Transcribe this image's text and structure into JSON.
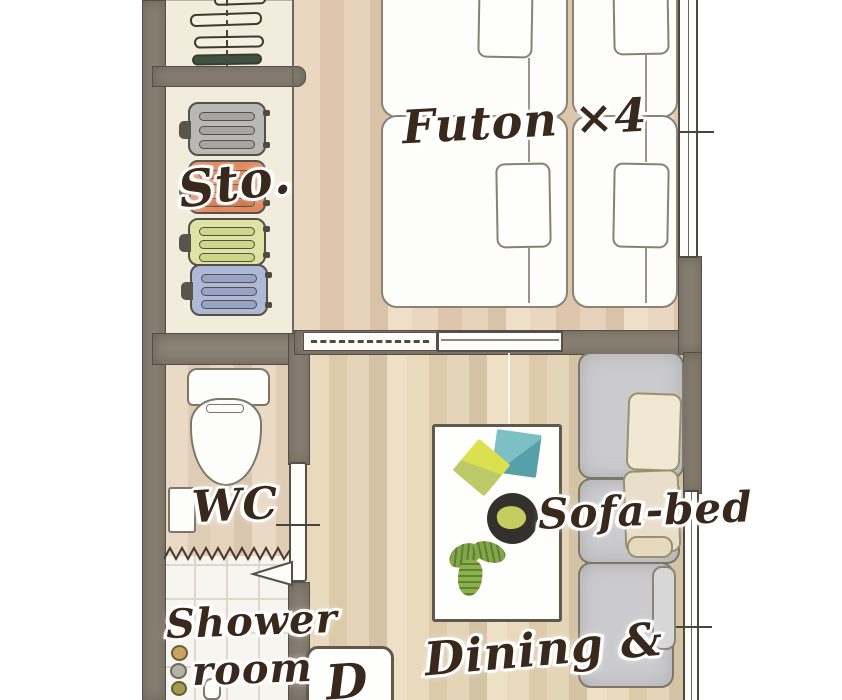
{
  "title": "guesthouse-floor-plan",
  "labels": {
    "futon": "Futon ×4",
    "storage": "Sto.",
    "wc": "WC",
    "shower1": "Shower",
    "shower2": "room",
    "sofa": "Sofa-bed",
    "dining": "Dining &",
    "d": "D"
  },
  "rooms": [
    {
      "name": "futon-room",
      "furniture": [
        "futon",
        "futon",
        "futon",
        "futon",
        "pillows"
      ]
    },
    {
      "name": "closet",
      "furniture": [
        "hangers"
      ]
    },
    {
      "name": "storage",
      "furniture": [
        "suitcase-gray",
        "suitcase-orange",
        "suitcase-green",
        "suitcase-blue"
      ]
    },
    {
      "name": "wc",
      "furniture": [
        "toilet",
        "paper-holder"
      ]
    },
    {
      "name": "shower-room",
      "furniture": [
        "shower-controls",
        "shower-head"
      ]
    },
    {
      "name": "living-dining",
      "furniture": [
        "dining-table",
        "placemats",
        "bowl",
        "plant",
        "sofa-bed",
        "d-tile"
      ]
    }
  ],
  "palette": {
    "wall": "#8d8577",
    "outline": "#55504a",
    "futon_floor": "#e6d2ba",
    "living_floor": "#e4d5b8",
    "closet_floor": "#f1ecdb",
    "shower_tile": "#f7f5ef",
    "text": "#39281c",
    "suitcase_gray": "#bab8b5",
    "suitcase_orange": "#e08a5f",
    "suitcase_green": "#dfe3a4",
    "suitcase_blue": "#aeb9d7",
    "sofa_gray": "#cbcbcd",
    "cushion_cream": "#f0e8d3",
    "placemat_teal": "#6fb5bb",
    "placemat_lime": "#d8dd52",
    "bowl": "#34302c",
    "plant": "#82a748",
    "hanger_green": "#3c5340"
  }
}
